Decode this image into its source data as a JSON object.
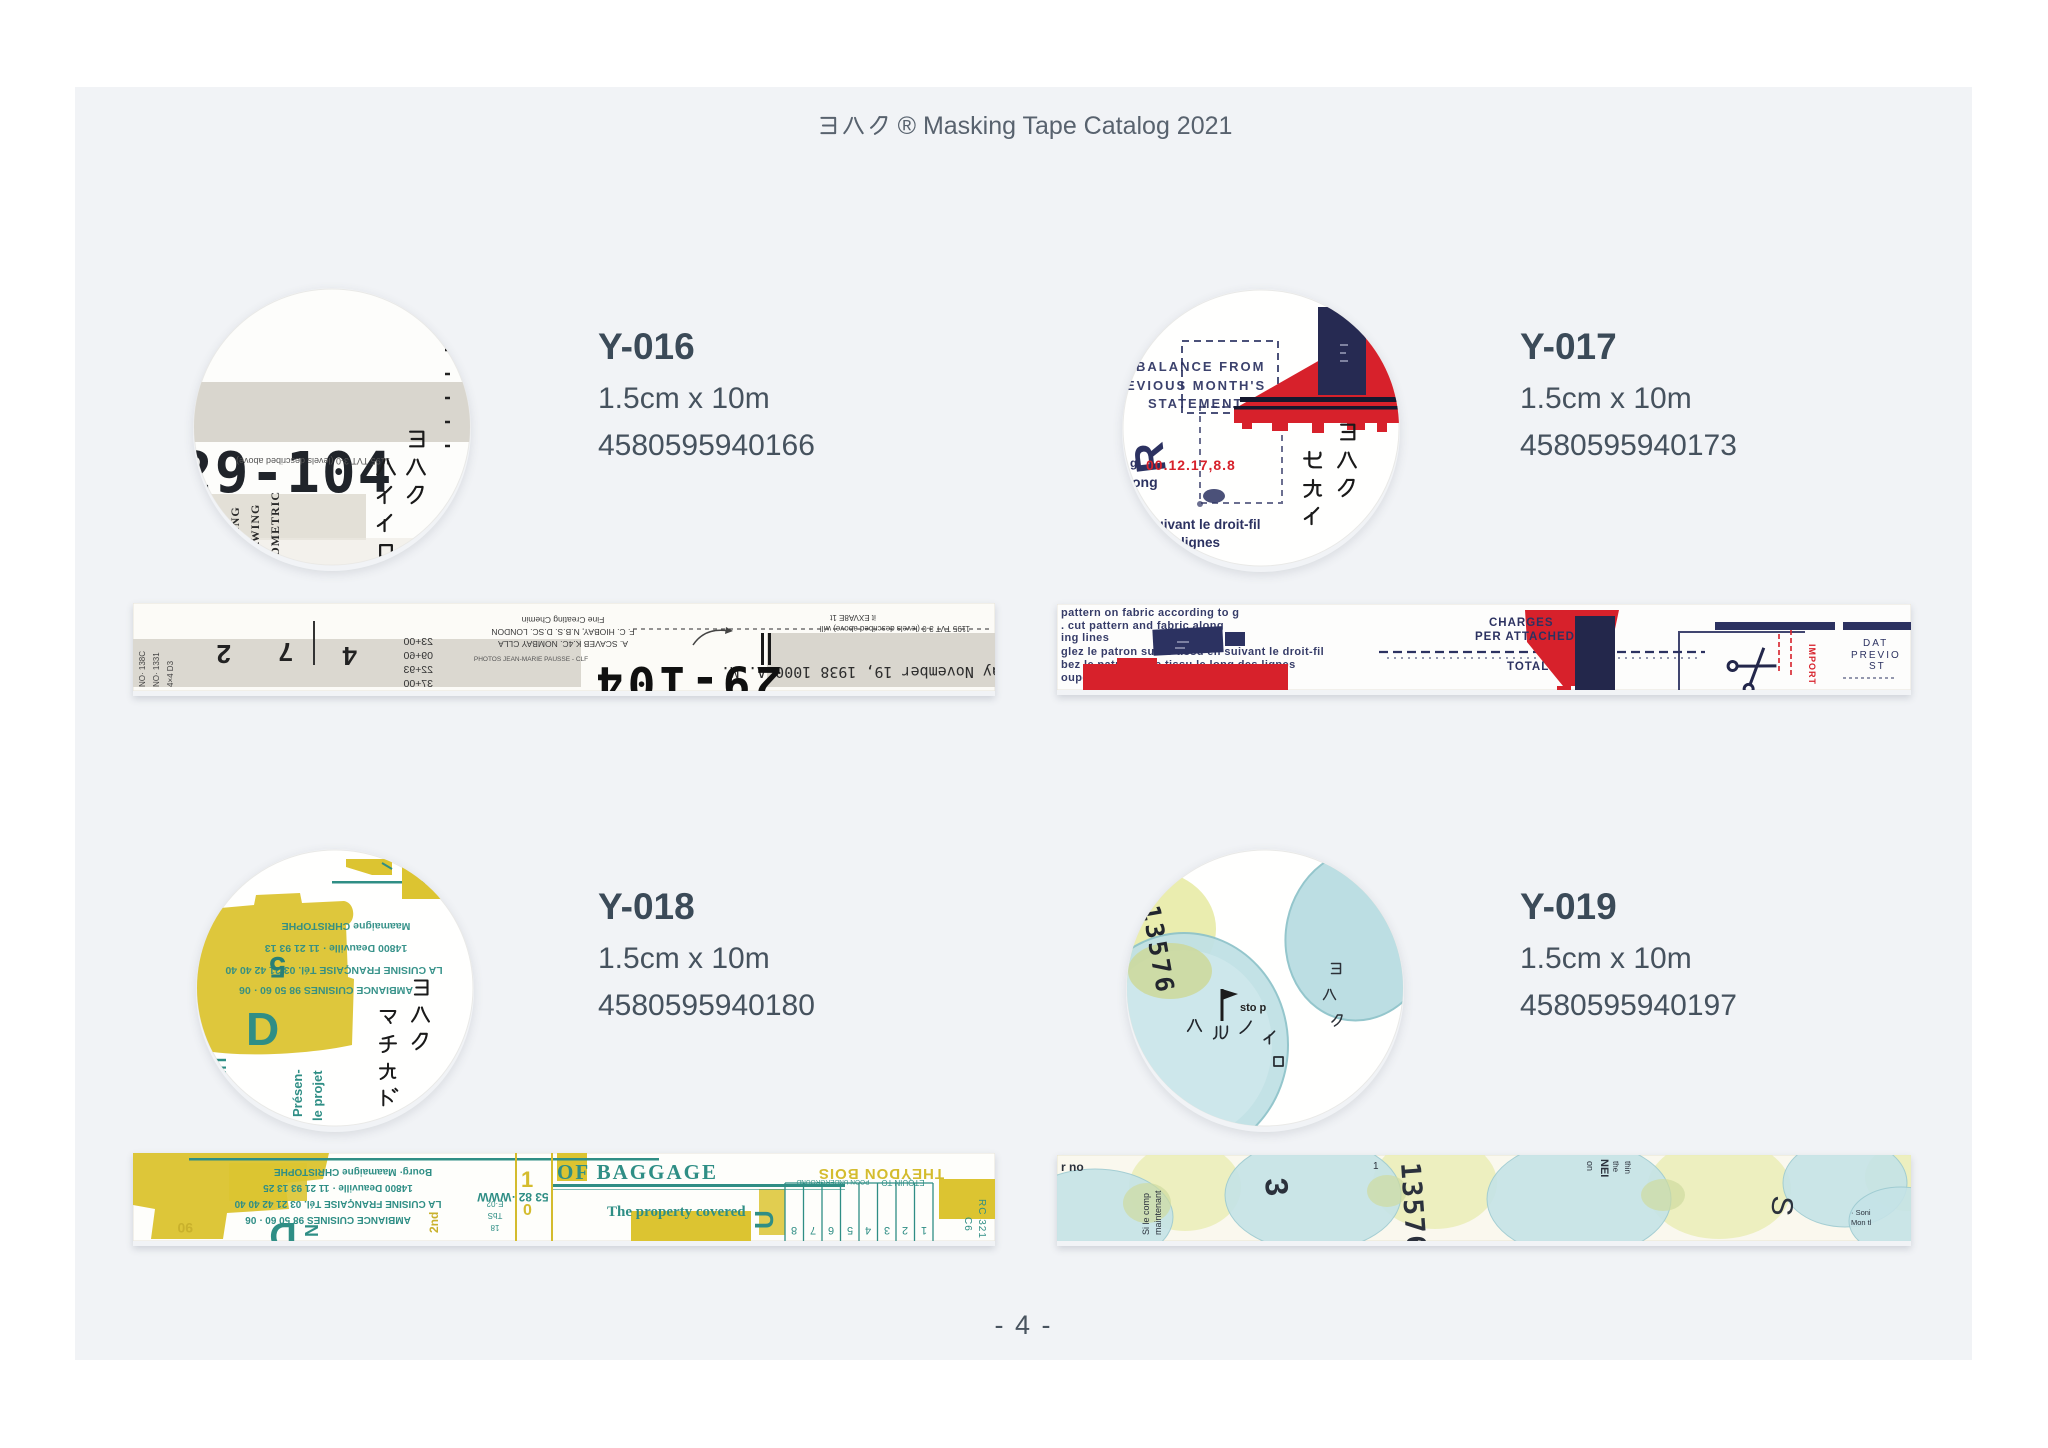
{
  "header": {
    "brand_jp": "ヨハク",
    "title_suffix": "® Masking Tape Catalog 2021",
    "full_title": "ヨハク® Masking Tape Catalog 2021"
  },
  "footer": {
    "page_number": "- 4 -"
  },
  "products": [
    {
      "code": "Y-016",
      "size": "1.5cm x 10m",
      "barcode": "4580595940166",
      "swatch": {
        "kana_right": "ヨハク",
        "kana_left": "ハイイロ",
        "big_number": "29-104",
        "mirrored_caption": "1195 TVT 3-0 (levels described above)",
        "vertical_words": [
          "TRACING",
          "DRAWING",
          "ISOMETRIC"
        ]
      },
      "tape": {
        "big_number": "29-104",
        "date_line": "..rday November 19, 1938 1000 A. M.",
        "digits": [
          "2",
          "7",
          "4"
        ],
        "number_column": [
          "23+00",
          "09+60",
          "22+93",
          "37+00"
        ],
        "caption_lines": [
          "Fine Creating Chemin",
          "F. C. HIOBAY, N.B.S. D.SC. LONDON",
          "A. SCAVEB K.4C. NOMBAY CLLA"
        ],
        "caption_small": [
          "it EXVA8E 1t",
          "1195 TVT 3-0 (levels described above) will"
        ],
        "photo_credit": "PHOTOS JEAN-MARIE PAUSSE - CLF",
        "side_codes": [
          "NO· 138C",
          "NO· 1331",
          "4×4 D3"
        ]
      }
    },
    {
      "code": "Y-017",
      "size": "1.5cm x 10m",
      "barcode": "4580595940173",
      "swatch": {
        "kana_right": "ヨハク",
        "kana_left": "セカイ",
        "stamp_lines": [
          "BALANCE FROM",
          "EVIOUS MONTH'S",
          "STATEMENT"
        ],
        "red_date": "00.12.17,8.8",
        "prefix": "g.",
        "letter": "R",
        "small_word": "ong",
        "french_lines": [
          "suivant le droit-fil",
          "des lignes"
        ]
      },
      "tape": {
        "text_lines": [
          "pattern on fabric according to g",
          ". cut pattern and fabric along",
          "ing lines",
          "glez le patron sur le tissu en suivant le droit-fil",
          "bez le patron et le tissu le long des lignes",
          "oupe la tela siguiendo el hilo"
        ],
        "charges": [
          "CHARGES",
          "PER ATTACHED"
        ],
        "total": "TOTAL",
        "import_vertical": "IMPORT",
        "right_lines": [
          "DAT",
          "PREVIO",
          "ST"
        ]
      }
    },
    {
      "code": "Y-018",
      "size": "1.5cm x 10m",
      "barcode": "4580595940180",
      "swatch": {
        "kana_right": "ヨハク",
        "kana_left": "マチカド",
        "teal_lines": [
          "Maamaigne CHRISTOPHE",
          "14800 Deauville · 11 21 93 13",
          "LA CUISINE FRANÇAISE Tél. 03 21 42 40 40",
          "AMBIANCE CUISINES 98 50 60 · 06"
        ],
        "big_digit": "5",
        "big_letter": "D",
        "vertical_word": "MEMI",
        "rotated_words": [
          "Présen-",
          "le projet"
        ]
      },
      "tape": {
        "headline": "OF BAGGAGE",
        "subline": "The property covered",
        "upside_lines": [
          "Bourg· Maamaigne CHRISTOPHE",
          "14800 Deauville · 11 21 93 13 25",
          "LA CUISINE FRANÇAISE Tél. 03 21 42 40 40",
          "AMBIANCE CUISINES 98 50 60 · 06"
        ],
        "yellow_word": "THEYDON BOIS",
        "small_words": [
          "ETQUIN TO",
          "POON UNDERGROUND"
        ],
        "www_text": "53 82 ·WWW",
        "big_letter": "D",
        "letter_u": "U",
        "letter_n": "N",
        "word_2nd": "2nd",
        "yellow_digits": [
          "1",
          "0"
        ],
        "left_yellow": "90",
        "tiny_column": [
          "E·02",
          "TbS",
          "18"
        ],
        "cell_numbers": [
          "8",
          "7",
          "6",
          "5",
          "4",
          "3",
          "2",
          "1"
        ],
        "side_code": [
          "RC 321",
          "C6"
        ]
      }
    },
    {
      "code": "Y-019",
      "size": "1.5cm x 10m",
      "barcode": "4580595940197",
      "swatch": {
        "kana_diagonal": "ハルノイロ",
        "kana_col": "ヨハク",
        "number": "13576",
        "stop_text": "sto p"
      },
      "tape": {
        "number": "13576",
        "digit_1": "1",
        "digit_3": "3",
        "letter": "S",
        "left_text": "r no",
        "rotated_lines": [
          "Si le comp",
          "maintenant"
        ],
        "small_lines": [
          "on",
          "NEI",
          "the",
          "thin"
        ],
        "credit_lines": [
          "· Soni",
          "Mon  tl"
        ]
      }
    }
  ]
}
